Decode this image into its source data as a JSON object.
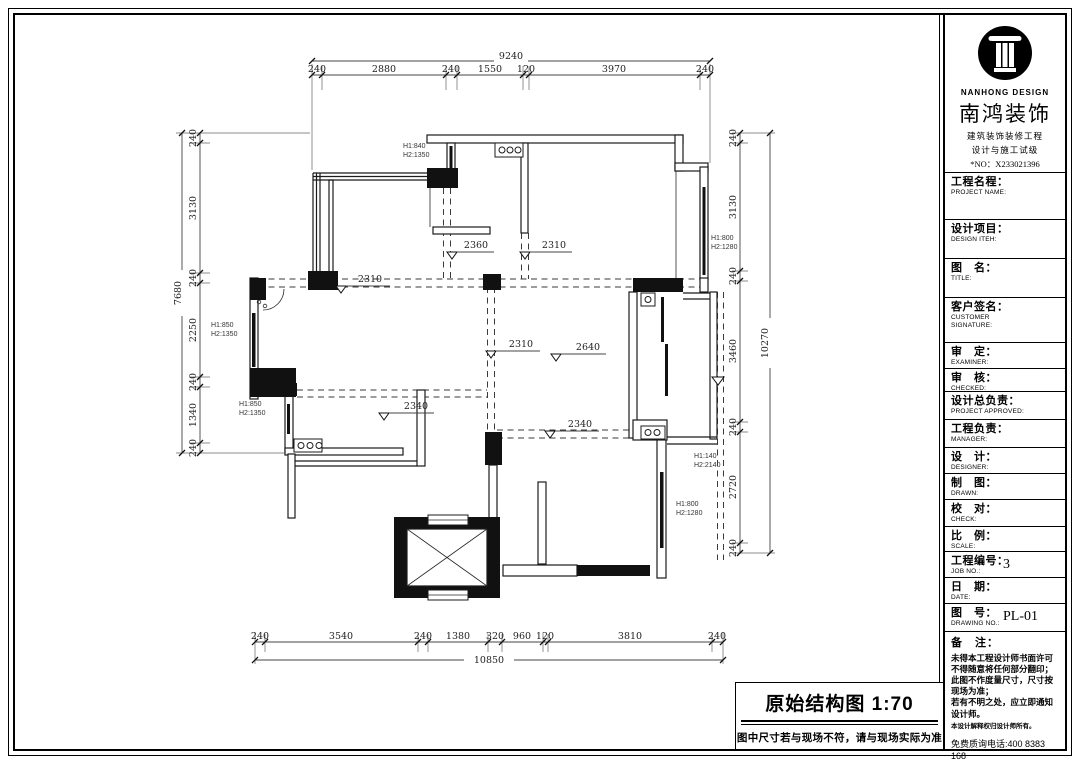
{
  "sheet": {
    "caption": {
      "title": "原始结构图",
      "scale_text": "1:70",
      "note": "图中尺寸若与现场不符，请与现场实际为准"
    }
  },
  "titleblock": {
    "brand": {
      "en": "NANHONG DESIGN",
      "cn": "南鸿装饰",
      "sub1": "建筑装饰装修工程",
      "sub2": "设计与施工试级",
      "no": "*NO：X233021396"
    },
    "fields": [
      {
        "cn": "工程名程：",
        "en": "PROJECT NAME:",
        "value": ""
      },
      {
        "cn": "设计项目：",
        "en": "DESIGN ITEH:",
        "value": ""
      },
      {
        "cn": "图　名：",
        "en": "TITLE:",
        "value": ""
      },
      {
        "cn": "客户签名：",
        "en": "CUSTOMER SIGNATURE:",
        "value": ""
      },
      {
        "cn": "审　定：",
        "en": "EXAMINER:",
        "value": ""
      },
      {
        "cn": "审　核：",
        "en": "CHECKED:",
        "value": ""
      },
      {
        "cn": "设计总负责：",
        "en": "PROJECT APPROVED:",
        "value": ""
      },
      {
        "cn": "工程负责：",
        "en": "MANAGER:",
        "value": ""
      },
      {
        "cn": "设　计：",
        "en": "DESIGNER:",
        "value": ""
      },
      {
        "cn": "制　图：",
        "en": "DRAWN:",
        "value": ""
      },
      {
        "cn": "校　对：",
        "en": "CHECK:",
        "value": ""
      },
      {
        "cn": "比　例：",
        "en": "SCALE:",
        "value": ""
      },
      {
        "cn": "工程编号：",
        "en": "JOB  NO.:",
        "value": "3"
      },
      {
        "cn": "日　期：",
        "en": "DATE:",
        "value": ""
      },
      {
        "cn": "图　号：",
        "en": "DRAWING NO.:",
        "value": "PL-01"
      }
    ],
    "remark": {
      "label": "备　注：",
      "lines": [
        "未得本工程设计师书面许可不得随意将任何部分翻印；",
        "此图不作度量尺寸，尺寸按现场为准；",
        "若有不明之处，应立即通知设计师。"
      ],
      "fine": "本设计解释权归设计师所有。",
      "phone": "免费质询电话:400 8383 168"
    }
  },
  "plan": {
    "dim_top": {
      "total": "9240",
      "segs": [
        "240",
        "2880",
        "240",
        "1550",
        "120",
        "3970",
        "240"
      ]
    },
    "dim_bottom": {
      "total": "10850",
      "segs": [
        "240",
        "3540",
        "240",
        "1380",
        "320",
        "960",
        "120",
        "3810",
        "240"
      ]
    },
    "dim_left": {
      "total": "7680",
      "segs": [
        "240",
        "3130",
        "240",
        "2250",
        "240",
        "1340",
        "240"
      ]
    },
    "dim_right": {
      "total": "10270",
      "segs": [
        "240",
        "3130",
        "240",
        "3460",
        "240",
        "2720",
        "240"
      ]
    },
    "inner_dims": {
      "a": "2360",
      "b": "2310",
      "c": "2310",
      "d": "2310",
      "e": "2640",
      "f": "2340",
      "g": "2340"
    },
    "height_labels": {
      "h1": {
        "l1": "H1:840",
        "l2": "H2:1350"
      },
      "h2": {
        "l1": "H1:850",
        "l2": "H2:1350"
      },
      "h3": {
        "l1": "H1:850",
        "l2": "H2:1350"
      },
      "h4": {
        "l1": "H1:800",
        "l2": "H2:1280"
      },
      "h5": {
        "l1": "H1:140",
        "l2": "H2:2140"
      },
      "h6": {
        "l1": "H1:800",
        "l2": "H2:1280"
      }
    }
  }
}
